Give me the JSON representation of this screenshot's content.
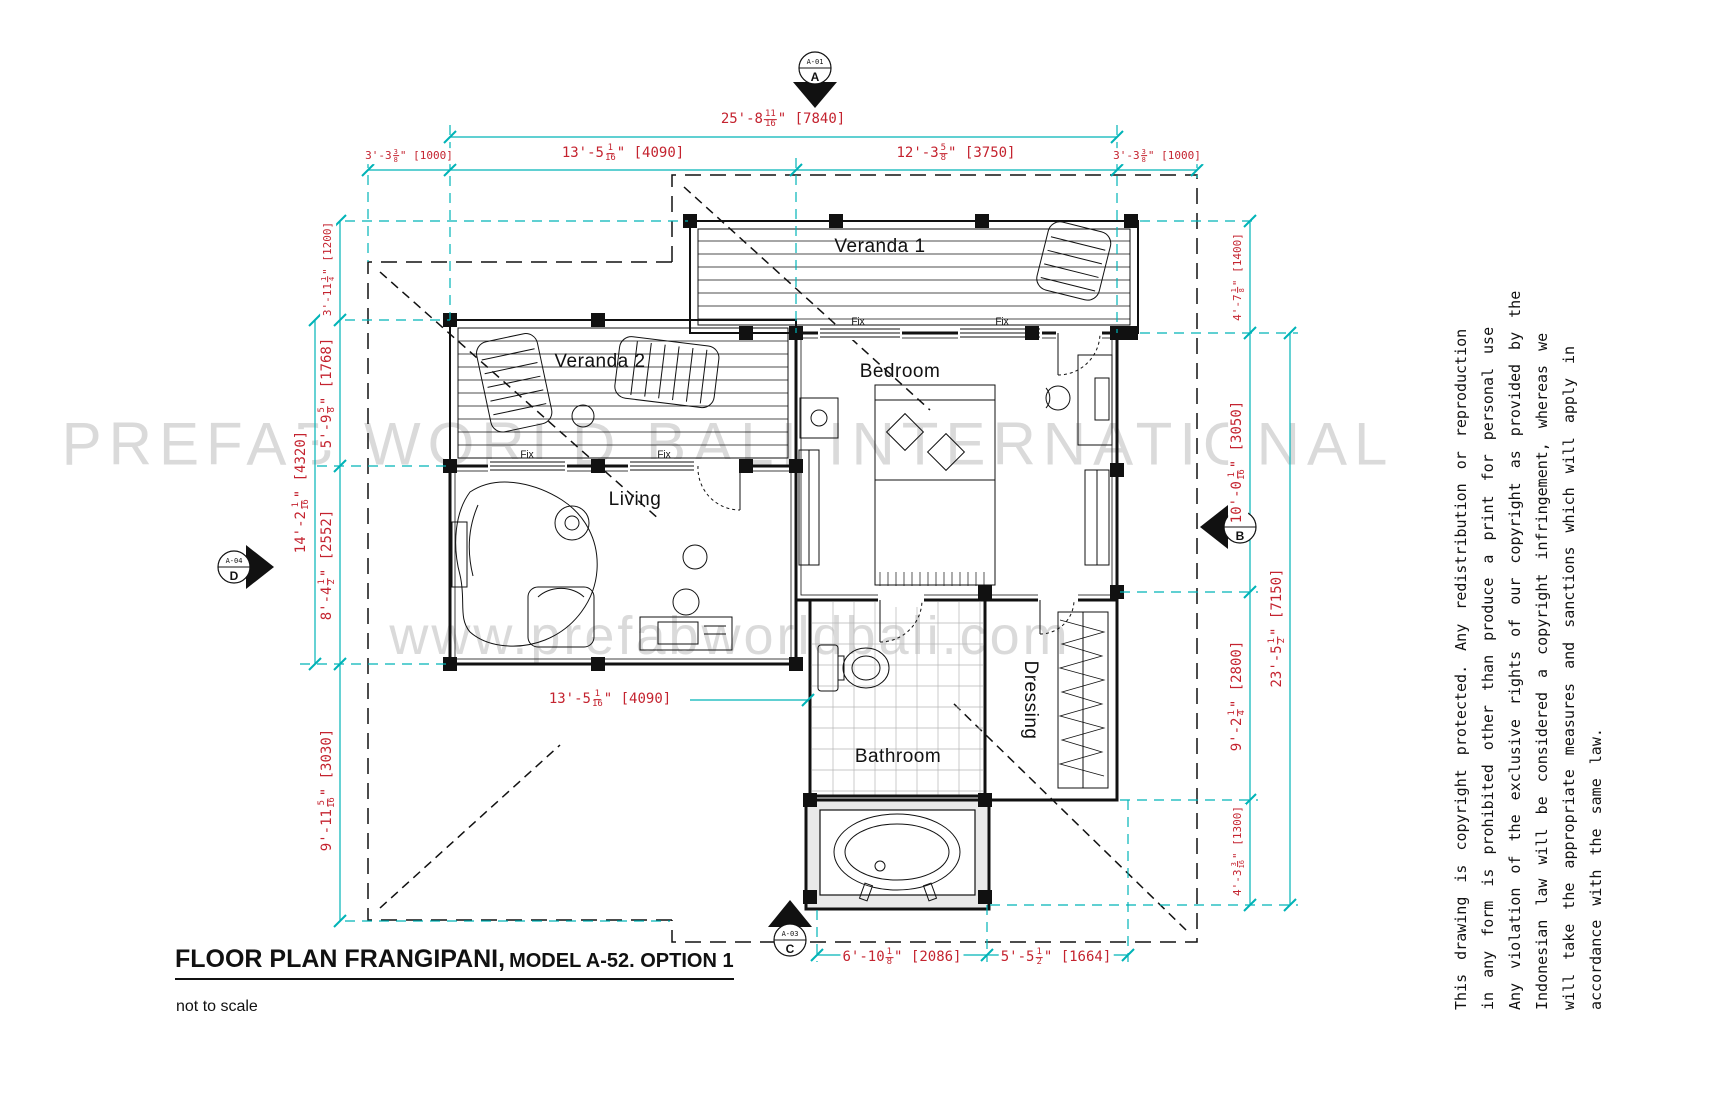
{
  "title": {
    "main": "FLOOR PLAN FRANGIPANI,",
    "model": "MODEL A-52. OPTION 1",
    "scale_note": "not to scale"
  },
  "watermarks": {
    "brand": "PREFAB WORLD BALI INTERNATIONAL",
    "website": "www.prefabworldbali.com"
  },
  "copyright_lines": [
    "This drawing is copyright protected. Any redistribution or reproduction",
    "in any form is prohibited other than produce a print for personal use",
    "Any violation of the exclusive rights of our copyright as provided by the",
    "Indonesian law will be considered a copyright infringement, whereas we",
    "will take the appropriate measures and sanctions which will apply in",
    "accordance with the same law."
  ],
  "rooms": {
    "veranda1": "Veranda 1",
    "veranda2": "Veranda 2",
    "bedroom": "Bedroom",
    "living": "Living",
    "bathroom": "Bathroom",
    "dressing": "Dressing"
  },
  "window_label": "Fix",
  "markers": {
    "top": {
      "letter": "A",
      "ref": "A-01"
    },
    "right": {
      "letter": "B",
      "ref": "A-02"
    },
    "bottom": {
      "letter": "C",
      "ref": "A-03"
    },
    "left": {
      "letter": "D",
      "ref": "A-04"
    }
  },
  "colors": {
    "dimension_text": "#c4232f",
    "dimension_line": "#00b3b7",
    "drawing": "#111111",
    "watermark": "#dadada"
  },
  "dimensions": {
    "top_total": {
      "a": "25'-8",
      "n": "11",
      "d": "16",
      "b": "\" [7840]"
    },
    "top_left_offset": {
      "a": "3'-3",
      "n": "3",
      "d": "8",
      "b": "\" [1000]"
    },
    "top_seg_living": {
      "a": "13'-5",
      "n": "1",
      "d": "16",
      "b": "\" [4090]"
    },
    "top_seg_bedroom": {
      "a": "12'-3",
      "n": "5",
      "d": "8",
      "b": "\" [3750]"
    },
    "top_right_offset": {
      "a": "3'-3",
      "n": "3",
      "d": "8",
      "b": "\" [1000]"
    },
    "left_veranda_offset": {
      "a": "3'-11",
      "n": "1",
      "d": "4",
      "b": "\" [1200]"
    },
    "left_veranda_depth": {
      "a": "5'-9",
      "n": "5",
      "d": "8",
      "b": "\" [1768]"
    },
    "left_total": {
      "a": "14'-2",
      "n": "1",
      "d": "16",
      "b": "\" [4320]"
    },
    "left_living_depth": {
      "a": "8'-4",
      "n": "1",
      "d": "2",
      "b": "\" [2552]"
    },
    "left_bottom_offset": {
      "a": "9'-11",
      "n": "5",
      "d": "16",
      "b": "\" [3030]"
    },
    "right_veranda_depth": {
      "a": "4'-7",
      "n": "1",
      "d": "8",
      "b": "\" [1400]"
    },
    "right_bedroom_depth": {
      "a": "10'-0",
      "n": "1",
      "d": "16",
      "b": "\" [3050]"
    },
    "right_total": {
      "a": "23'-5",
      "n": "1",
      "d": "2",
      "b": "\" [7150]"
    },
    "right_bath_depth": {
      "a": "9'-2",
      "n": "1",
      "d": "4",
      "b": "\" [2800]"
    },
    "right_tub_depth": {
      "a": "4'-3",
      "n": "3",
      "d": "16",
      "b": "\" [1300]"
    },
    "mid_living_width": {
      "a": "13'-5",
      "n": "1",
      "d": "16",
      "b": "\" [4090]"
    },
    "bottom_tub_width": {
      "a": "6'-10",
      "n": "1",
      "d": "8",
      "b": "\" [2086]"
    },
    "bottom_dressing_width": {
      "a": "5'-5",
      "n": "1",
      "d": "2",
      "b": "\" [1664]"
    }
  }
}
